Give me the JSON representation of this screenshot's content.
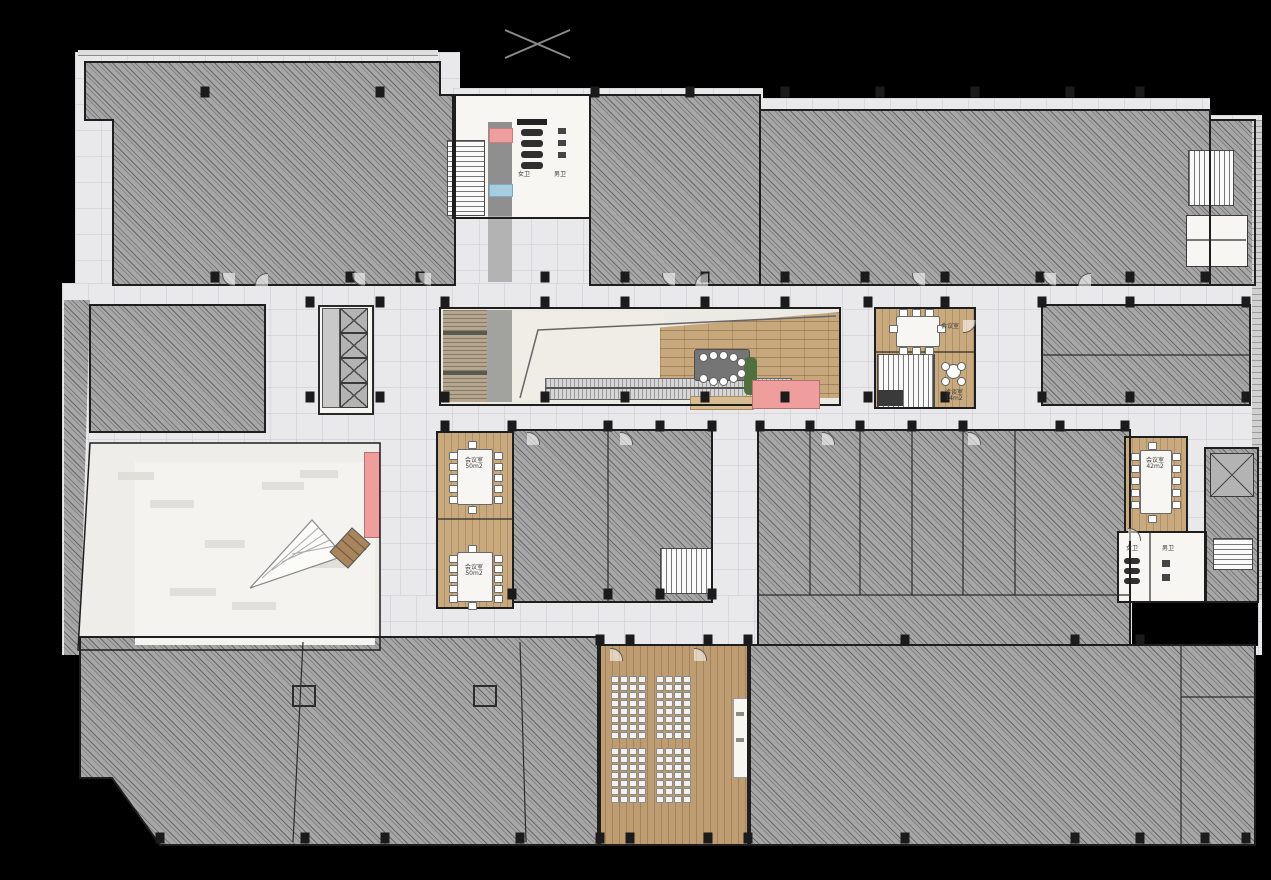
{
  "plan": {
    "kind": "architectural-floor-plan",
    "floor_style": "color presentation plan on black background"
  },
  "colors": {
    "background": "#000000",
    "hatch_fill": "#a7a7a7",
    "corridor": "#e9e9ec",
    "wood": "#c9aa7e",
    "auditorium_wood": "#bf9d72",
    "accent_pink": "#ef9e9e",
    "accent_blue": "#a5cfe0",
    "wall": "#1f1f1f",
    "white_floor": "#f3f2ee"
  },
  "rooms": {
    "meeting_a": {
      "name": "会议室",
      "area": "50m2"
    },
    "meeting_b": {
      "name": "会议室",
      "area": "50m2"
    },
    "meeting_c": {
      "name": "会议室",
      "area": "42m2"
    },
    "meeting_top": {
      "name": "会议室"
    },
    "lounge": {
      "name": "洽谈室",
      "area": "14m2"
    },
    "toilet_female": "女卫",
    "toilet_male": "男卫"
  },
  "auditorium": {
    "seat_blocks": [
      {
        "rows": 8,
        "cols": 4
      },
      {
        "rows": 8,
        "cols": 4
      },
      {
        "rows": 7,
        "cols": 4
      },
      {
        "rows": 7,
        "cols": 4
      }
    ],
    "total_seats": 120
  }
}
